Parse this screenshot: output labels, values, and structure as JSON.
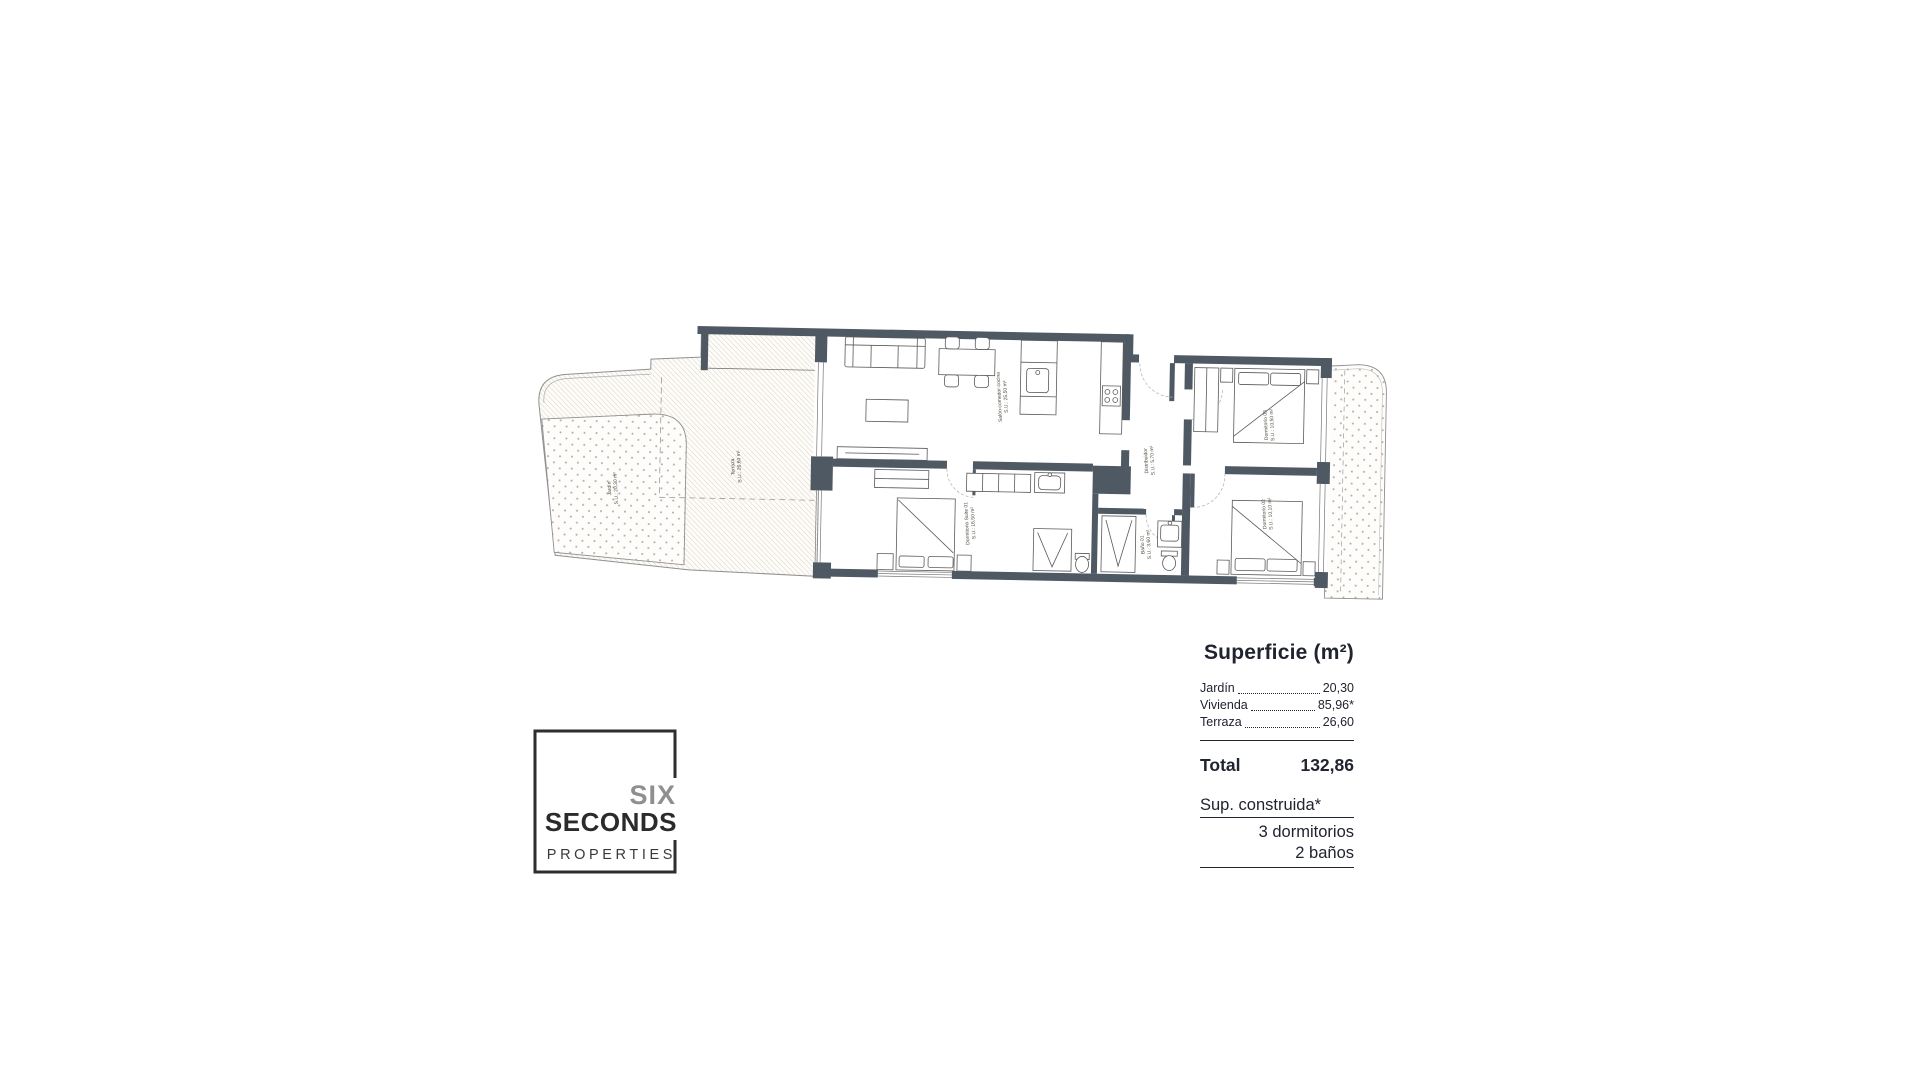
{
  "plan": {
    "rooms": [
      {
        "id": "jardin",
        "name": "Jardín",
        "area": "S.U.: 20,30 m²"
      },
      {
        "id": "terraza",
        "name": "Terraza",
        "area": "S.U.: 26,60 m²"
      },
      {
        "id": "salon",
        "name": "Salón-comedor-cocina",
        "area": "S.U.: 25,50 m²"
      },
      {
        "id": "suite",
        "name": "Dormitorio Suite 01",
        "area": "S.U.: 16,50 m²"
      },
      {
        "id": "distribuidor",
        "name": "Distribuidor",
        "area": "S.U.: 5,70 m²"
      },
      {
        "id": "bano01",
        "name": "Baño 01",
        "area": "S.U.: 3,60 m²"
      },
      {
        "id": "dorm03",
        "name": "Dormitorio 03",
        "area": "S.U.: 10,50 m²"
      },
      {
        "id": "dorm02",
        "name": "Dormitorio 02",
        "area": "S.U.: 10,10 m²"
      }
    ],
    "colors": {
      "wall": "#4f5963",
      "label": "#4b4e3e",
      "hatch": "#d8cfc2",
      "dots": "#b3ab9d"
    }
  },
  "summary": {
    "title": "Superficie (m²)",
    "rows": [
      {
        "label": "Jardín",
        "value": "20,30"
      },
      {
        "label": "Vivienda",
        "value": "85,96*"
      },
      {
        "label": "Terraza",
        "value": "26,60"
      }
    ],
    "total_label": "Total",
    "total_value": "132,86",
    "footnote": "Sup. construida*",
    "bedrooms": "3 dormitorios",
    "bathrooms": "2 baños"
  },
  "logo": {
    "line1": "SIX",
    "line2": "SECONDS",
    "line3": "PROPERTIES"
  }
}
